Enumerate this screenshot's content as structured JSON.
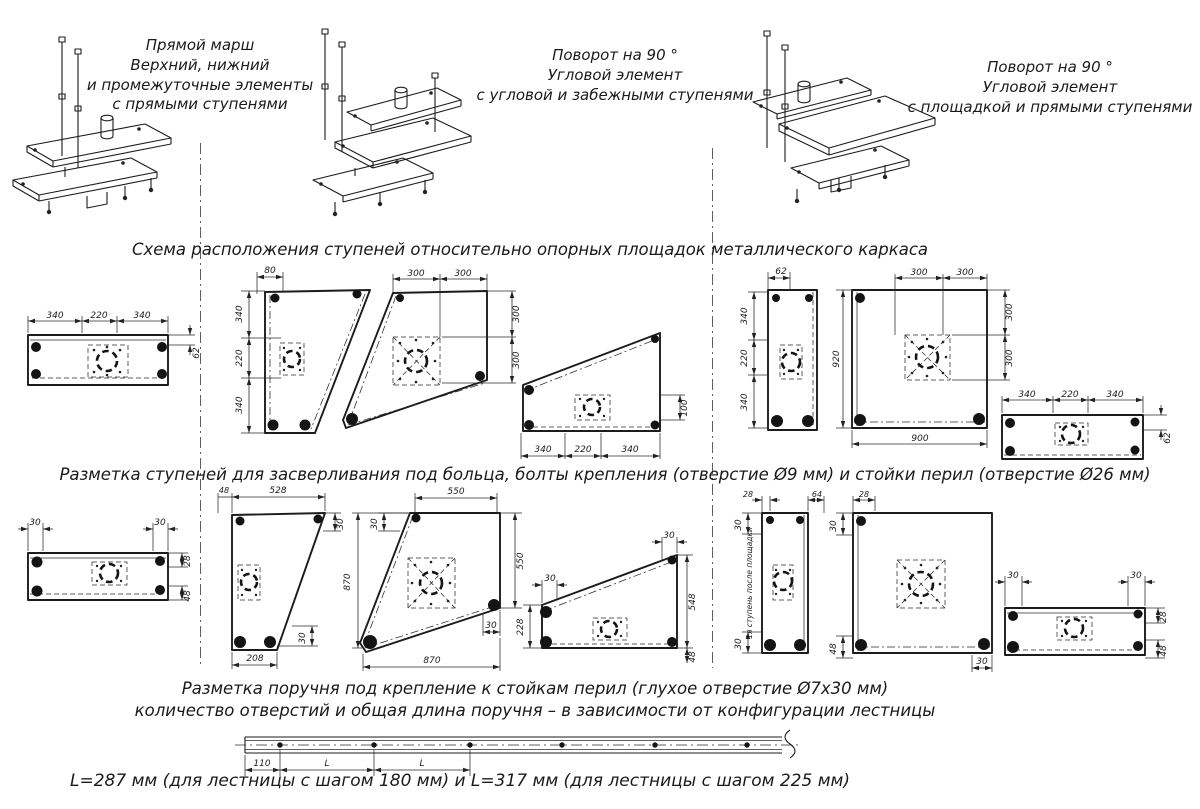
{
  "variants": [
    {
      "lines": [
        "Прямой марш",
        "Верхний, нижний",
        "и промежуточные элементы",
        "с прямыми ступенями"
      ]
    },
    {
      "lines": [
        "Поворот на 90 °",
        "Угловой элемент",
        "с угловой и забежными ступенями"
      ]
    },
    {
      "lines": [
        "Поворот на 90 °",
        "Угловой элемент",
        "с площадкой и прямыми ступенями"
      ]
    }
  ],
  "headings": {
    "layout": "Схема расположения ступеней относительно опорных площадок металлического каркаса",
    "drilling": "Разметка ступеней для засверливания под больца, болты крепления (отверстие Ø9 мм) и стойки перил (отверстие Ø26 мм)",
    "handrail_line1": "Разметка поручня под крепление к стойкам перил (глухое отверстие Ø7х30 мм)",
    "handrail_line2": "количество отверстий и общая длина поручня – в зависимости от конфигурации лестницы",
    "handrail_caption": "L=287 мм (для лестницы с шагом 180 мм) и L=317 мм (для лестницы с шагом 225 мм)"
  },
  "row1": {
    "straight_left": {
      "top": [
        "340",
        "220",
        "340"
      ],
      "side": "62"
    },
    "corner": {
      "top": "80",
      "left": [
        "340",
        "220",
        "340"
      ]
    },
    "winder": {
      "top": [
        "300",
        "300"
      ],
      "right": [
        "300",
        "300"
      ]
    },
    "diag": {
      "right": "100",
      "bottom": [
        "340",
        "220",
        "340"
      ]
    },
    "strip": {
      "top": "62",
      "left": [
        "340",
        "220",
        "340"
      ]
    },
    "platform": {
      "top": [
        "300",
        "300"
      ],
      "left": "920",
      "right": [
        "300",
        "300"
      ],
      "bottom": "900"
    },
    "straight_right": {
      "top": [
        "340",
        "220",
        "340"
      ],
      "side": "62"
    }
  },
  "row2": {
    "straight_left": {
      "top_left": "30",
      "top_right": "30",
      "right_top": "28",
      "right_bottom": "48"
    },
    "corner": {
      "top_offset": "48",
      "top": "528",
      "right": "30",
      "bottom_offset": "30",
      "bottom": "208"
    },
    "winder": {
      "top": "550",
      "top_offset": "30",
      "left": "870",
      "right": "550",
      "bottom_offset": "30",
      "bottom": "870"
    },
    "diag": {
      "top": "30",
      "left_offset": "30",
      "left": "228",
      "right": "548",
      "bottom": "48"
    },
    "strip": {
      "top_left": "28",
      "top_right": "64",
      "left_top": "30",
      "left_bottom": "30",
      "note": "1я ступень после площадки"
    },
    "platform": {
      "top": "28",
      "left_top": "30",
      "left_bottom": "48",
      "bottom": "30"
    },
    "straight_right": {
      "top_left": "30",
      "top_right": "30",
      "right_top": "28",
      "right_bottom": "48"
    }
  },
  "handrail": {
    "d1": "110",
    "d2": "L",
    "d3": "L"
  }
}
